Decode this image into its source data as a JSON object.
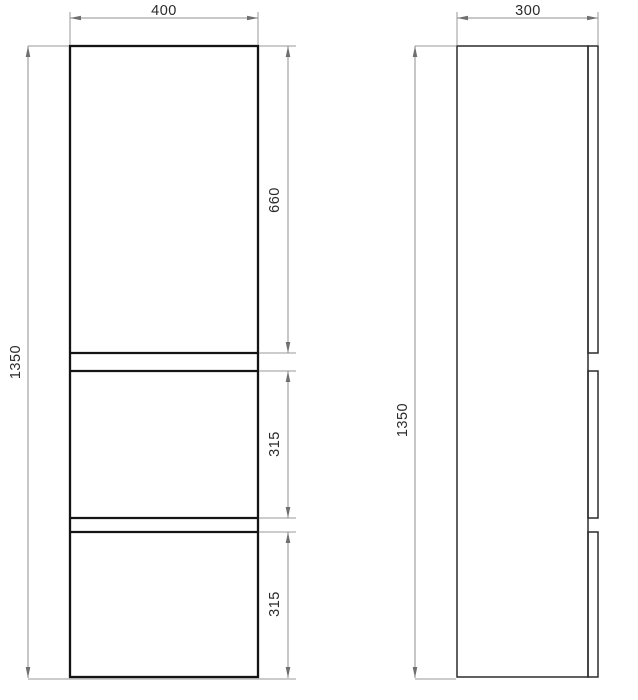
{
  "drawing": {
    "front_view": {
      "width_mm": "400",
      "height_mm": "1350",
      "top_section_mm": "660",
      "middle_section_mm": "315",
      "bottom_section_mm": "315"
    },
    "side_view": {
      "depth_mm": "300",
      "height_mm": "1350"
    },
    "colors": {
      "outline": "#141414",
      "side_outline": "#2b2b2b",
      "dimension_line": "#8f8f8f",
      "label_text": "#2a2a2a",
      "background": "#ffffff"
    }
  }
}
